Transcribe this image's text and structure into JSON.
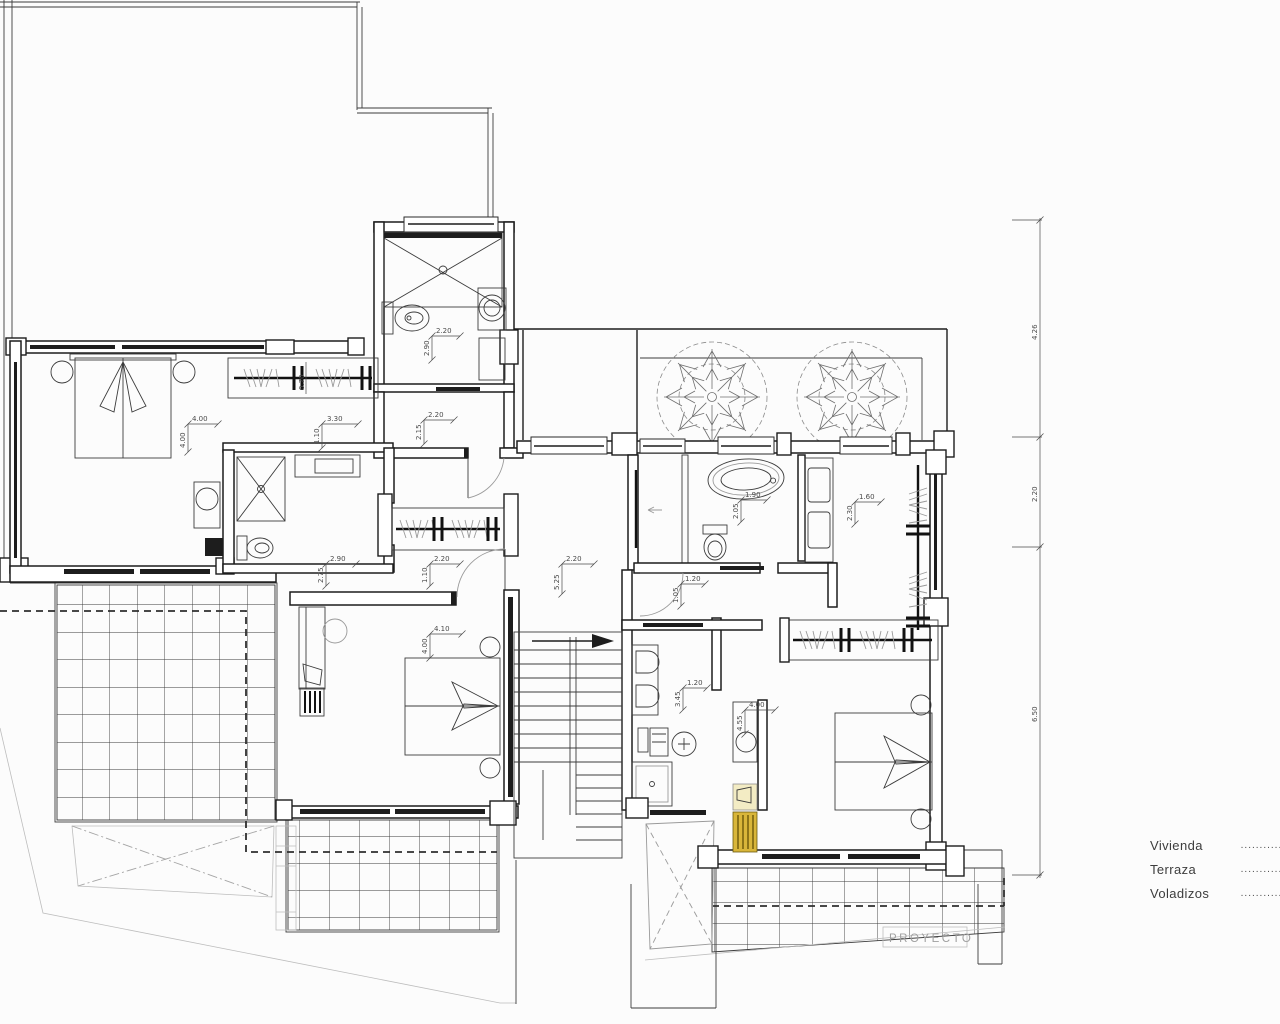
{
  "drawing": {
    "watermark": "PROYECTO",
    "legend": [
      {
        "label": "Vivienda",
        "dots": "............"
      },
      {
        "label": "Terraza",
        "dots": "............"
      },
      {
        "label": "Voladizos",
        "dots": "............"
      }
    ],
    "dim_chain": {
      "top": "4.26",
      "mid": "2.20",
      "bottom": "6.50"
    },
    "dims": {
      "bath_top_w": "2.20",
      "bath_top_h": "2.90",
      "hall_top_w": "2.20",
      "hall_top_h": "2.15",
      "bed1_w": "4.00",
      "bed1_h": "4.00",
      "closet1_w": "3.30",
      "closet1_h": "1.10",
      "closet1_d": "0.70",
      "bath_mid_w": "2.90",
      "bath_mid_h": "2.75",
      "hall_mid_w": "2.20",
      "hall_mid_h": "1.10",
      "landing_w": "2.20",
      "landing_h": "5.25",
      "bed2_w": "4.10",
      "bed2_h": "4.00",
      "mbath_w": "1.90",
      "mbath_h": "2.05",
      "mcloset_w": "1.60",
      "mcloset_h": "2.30",
      "hall_b_w": "1.20",
      "hall_b_h": "1.05",
      "bath3_w": "1.20",
      "bath3_h": "3.45",
      "bed3_w": "4.00",
      "bed3_h": "4.55"
    },
    "colors": {
      "highlight_gold": "#d9b63a",
      "paper": "#fcfcfc",
      "line": "#1d1d1d"
    }
  }
}
